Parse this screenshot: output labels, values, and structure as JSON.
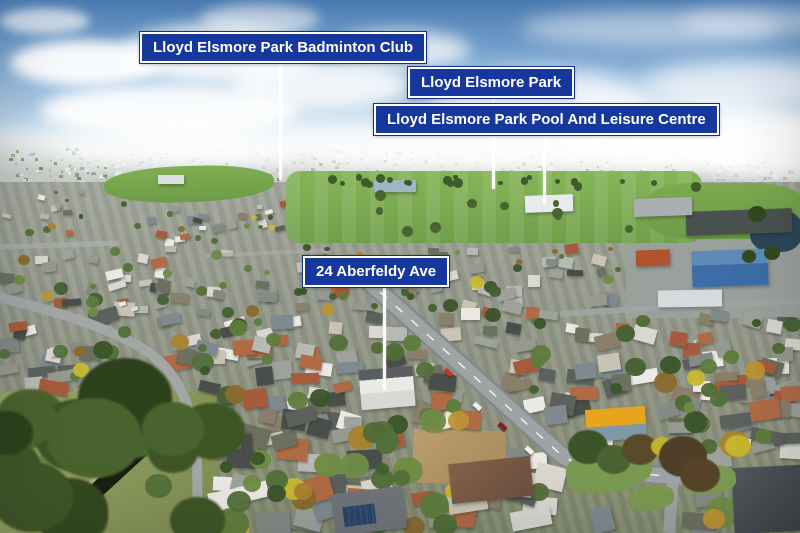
{
  "callouts": [
    {
      "text": "Lloyd Elsmore Park Badminton Club"
    },
    {
      "text": "Lloyd Elsmore Park"
    },
    {
      "text": "Lloyd Elsmore Park Pool And Leisure Centre"
    },
    {
      "text": "24 Aberfeldy Ave"
    }
  ],
  "colors": {
    "callout_background": "#16389c",
    "callout_border": "#ffffff",
    "callout_text": "#ffffff",
    "leader_line": "#ffffff",
    "sky": "#5b8cc4",
    "park_grass": "#77a64e"
  }
}
